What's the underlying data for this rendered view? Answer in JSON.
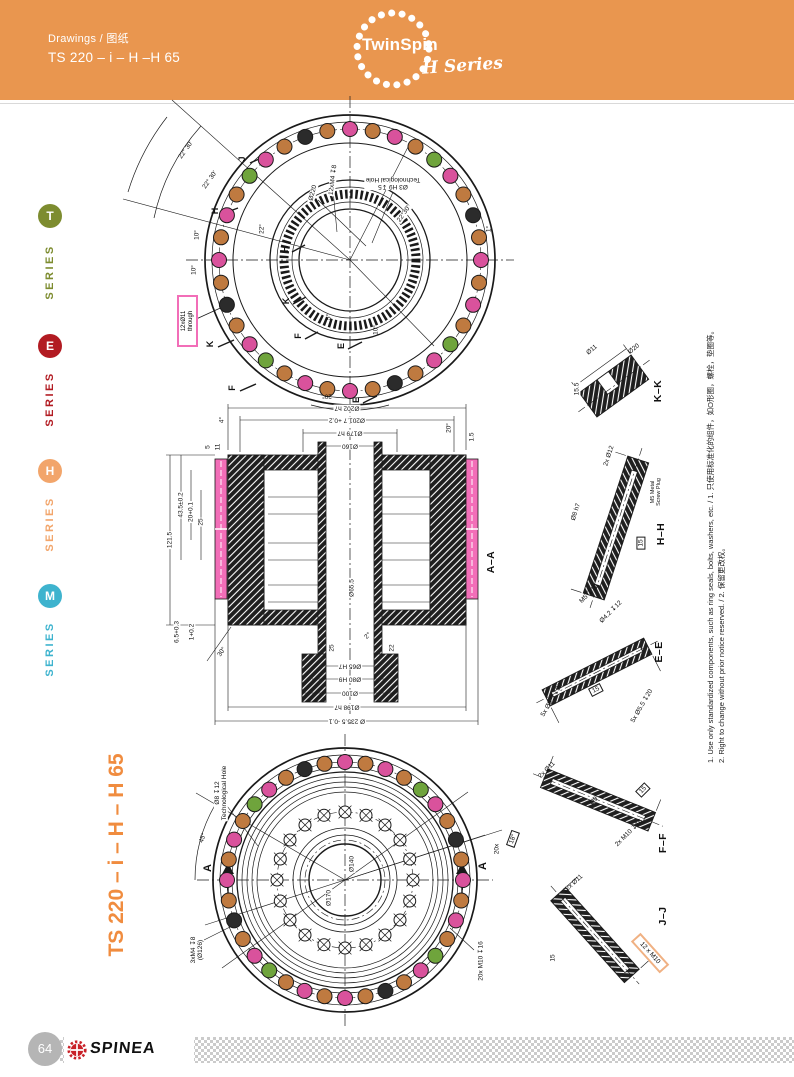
{
  "header": {
    "breadcrumb": "Drawings / 图纸",
    "title": "TS 220 – i – H –H 65",
    "logo": {
      "wordmark": "TwinSpin",
      "series": "H Series"
    }
  },
  "sidebar": {
    "items": [
      {
        "letter": "T",
        "label": "SERIES",
        "color": "#7D8C2F"
      },
      {
        "letter": "E",
        "label": "SERIES",
        "color": "#B21B22"
      },
      {
        "letter": "H",
        "label": "SERIES",
        "color": "#F2A56B"
      },
      {
        "letter": "M",
        "label": "SERIES",
        "color": "#3EB3CE"
      }
    ]
  },
  "side_title": "TS 220 – i – H – H 65",
  "notes": {
    "n1": "1. Use only standardized components, such as ring seals, bolts, washers, etc. / 1. 只使用标准化的组件，如O形圈，螺栓，垫圈等。",
    "n2": "2. Right to change without prior notice reserved. / 2. 保留更改权。"
  },
  "footer": {
    "page": "64",
    "brand": "SPINEA"
  },
  "colors": {
    "header_orange": "#E9964F",
    "divider": "#D9D9D9",
    "accent_orange": "#F08C3F",
    "highlight_pink": "#F26EB8",
    "highlight_orange": "#F0B183",
    "bolt_pink": "#D9529C",
    "bolt_orange": "#BF7A40",
    "bolt_green": "#6FA43C",
    "bolt_black": "#2B2B2B",
    "series_t": "#7D8C2F",
    "series_e": "#B21B22",
    "series_h": "#F2A56B",
    "series_m": "#3EB3CE",
    "footer_gray": "#B5B5B5",
    "footer_dots": "#CBCBCB",
    "spinea_red": "#C92128"
  },
  "drawing": {
    "top_view": {
      "d220": "Ø220",
      "tech1": "Ø3 H9 ↧5",
      "tech2": "Technological Hole",
      "m4": "12xM4 ↧8",
      "a2230": "22°30'",
      "arc1": "22° 30'",
      "arc2": "22° 30'",
      "j": "J",
      "h1": "H",
      "h2": "H",
      "k1": "K",
      "k2": "K",
      "f1": "F",
      "f2": "F",
      "e1": "E",
      "e2": "E",
      "a10a": "10°",
      "a10b": "10°",
      "a10c": "10°",
      "a22": "22°",
      "a5": "5°",
      "a20": "20°",
      "a1": "1°",
      "pink1": "12xØ11",
      "pink2": "through",
      "bolt_ring": {
        "layer": "bolts-top",
        "center": [
          350,
          260
        ],
        "radius": 131,
        "bolt_r": 7.5,
        "count": 36,
        "start_deg": 90,
        "pattern": [
          "pink",
          "orange",
          "black",
          "orange",
          "pink",
          "green",
          "orange",
          "pink",
          "orange",
          "pink",
          "orange",
          "black",
          "orange",
          "pink",
          "green",
          "orange",
          "pink",
          "orange"
        ]
      }
    },
    "section": {
      "name": "A–A",
      "dt1": "Ø202 h7",
      "dt2": "Ø201.7 +0.2",
      "dt3": "Ø179 h7",
      "dt4": "Ø160",
      "dl_taper": "4°",
      "dl5": "5",
      "dl11": "11",
      "dl435": "43.5±0.2",
      "dl20": "20+0.1",
      "dl25": "25",
      "dl1215": "121.5",
      "dl65": "6.5+0.3",
      "dl1": "1+0.2",
      "dl30": "30°",
      "dc20": "20°",
      "dc15": "1.5",
      "db655": "Ø65.5",
      "db25": "25",
      "db22": "22",
      "db2": "2°",
      "db65": "Ø65 H7",
      "db80": "Ø80 H9",
      "db100": "Ø100",
      "db198": "Ø198 h7",
      "db2355": "Ø 235.5 -0.1"
    },
    "bottom_view": {
      "a45": "45°",
      "tech1": "Ø8 ↧12",
      "tech2": "Technological Hole",
      "aL": "A",
      "aR": "A",
      "c20x": "20x",
      "box18": "18°",
      "d140": "Ø140",
      "d170": "Ø170",
      "m4a": "3xM4 ↧8",
      "m4b": "(Ø126)",
      "m10": "20x M10 ↧16",
      "bolt_ring": {
        "layer": "bolts-bottom",
        "center": [
          345,
          880
        ],
        "radius": 118,
        "bolt_r": 7.5,
        "count": 36,
        "start_deg": 90,
        "pattern": [
          "pink",
          "orange",
          "black",
          "orange",
          "pink",
          "green",
          "orange",
          "pink",
          "orange",
          "pink",
          "orange",
          "black",
          "orange",
          "pink",
          "green",
          "orange",
          "pink",
          "orange"
        ]
      },
      "small_ring": {
        "layer": "bolts-bottom-small",
        "center": [
          345,
          880
        ],
        "radius": 68,
        "bolt_r": 6,
        "count": 20,
        "start_deg": 90,
        "cross": true
      }
    },
    "details": {
      "kk": {
        "name": "K–K",
        "d11": "Ø11",
        "d20": "Ø20",
        "d155": "15.5"
      },
      "hh": {
        "name": "H–H",
        "l1": "2x Ø12",
        "l2": "Ø8 h7",
        "l3": "15",
        "l4": "M5 ↧10",
        "l5": "Ø4.2 ↧12",
        "plug1": "M5 Metal",
        "plug2": "Screw Plug"
      },
      "ee": {
        "name": "E–E",
        "l1": "5x Ø5.5 ↧20",
        "l2": "15",
        "l3": "5x Ø5.5 ↧20"
      },
      "ff": {
        "name": "F–F",
        "l1": "2x Ø11",
        "l2": "Ø9",
        "l3": "15",
        "l4": "2x M10 ↧16"
      },
      "jj": {
        "name": "J–J",
        "l1": "12x Ø11",
        "l2": "15",
        "box": "12 x M10"
      }
    }
  }
}
